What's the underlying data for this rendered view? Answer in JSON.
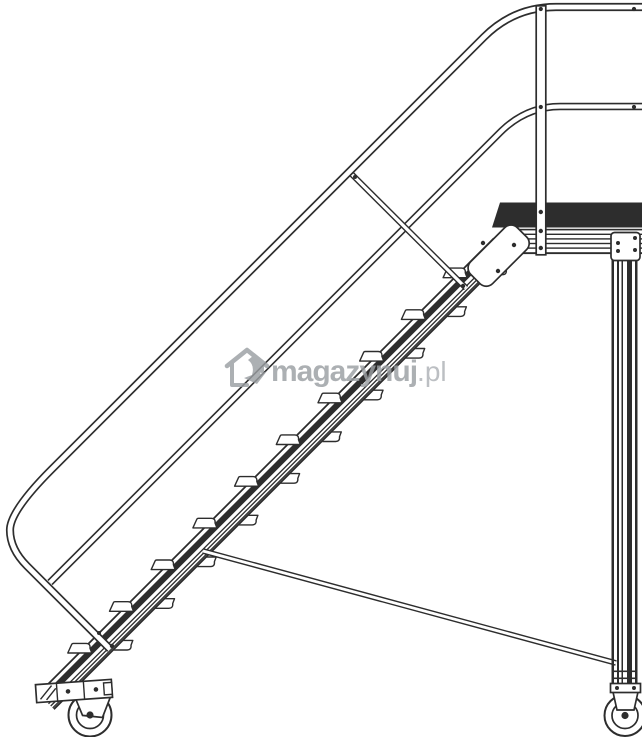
{
  "canvas": {
    "width": 642,
    "height": 737,
    "background": "#ffffff"
  },
  "artwork": {
    "line_color": "#2d2d2d",
    "watermark_color": "#9b9fa3",
    "watermark_suffix_color": "#aeb2b6"
  },
  "watermark": {
    "brand": "magazynuj",
    "suffix": ".pl"
  },
  "steps": {
    "count": 10,
    "first_x": 79.8,
    "first_y": 651.6,
    "dx": 41.7,
    "dy": -41.7,
    "far_offset_x": 41,
    "far_offset_y": -9.8
  }
}
